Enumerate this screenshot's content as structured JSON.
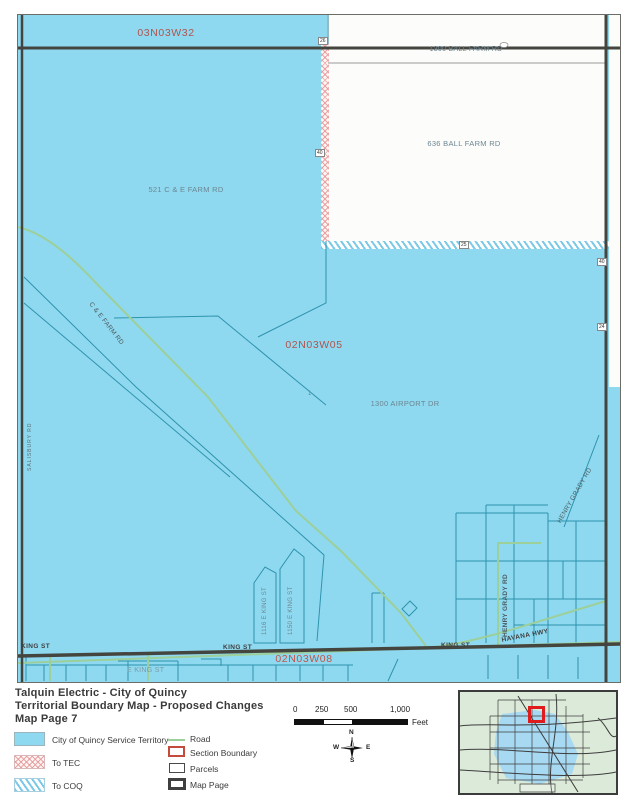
{
  "map": {
    "section_labels": {
      "nw": "03N03W32",
      "center": "02N03W05",
      "south": "02N03W08"
    },
    "parcel_labels": {
      "ball_farm_1300": "1300 BALL FARM RD",
      "ball_farm_636": "636 BALL FARM RD",
      "ce_farm_521": "521 C & E FARM RD",
      "airport_1300": "1300 AIRPORT DR",
      "lot_1": "1",
      "king_1116": "1116 E KING ST",
      "king_1150": "1150 E KING ST"
    },
    "road_labels": {
      "ce_farm": "C & E FARM RD",
      "king_w": "KING ST",
      "king_c": "KING ST",
      "king_e": "KING ST",
      "e_king": "E KING ST",
      "havana": "HAVANA HWY",
      "henry_grady_road": "HENRY GRADY RD",
      "henry_grady_edge": "HENRY GRADY RD",
      "west_edge_road": "SALISBURY RD"
    },
    "edge_markers": {
      "m26": "26",
      "m40a": "40",
      "m25": "25",
      "m40b": "40",
      "m24": "24"
    }
  },
  "legend": {
    "title1": "Talquin Electric - City of Quincy",
    "title2": "Territorial Boundary Map - Proposed Changes",
    "title3": "Map Page 7",
    "items_left": [
      {
        "label": "City of Quincy Service Territory"
      },
      {
        "label": "To TEC"
      },
      {
        "label": "To COQ"
      }
    ],
    "items_right": [
      {
        "label": "Road"
      },
      {
        "label": "Section Boundary"
      },
      {
        "label": "Parcels"
      },
      {
        "label": "Map Page"
      }
    ]
  },
  "scale": {
    "ticks": [
      "0",
      "250",
      "500",
      "1,000"
    ],
    "unit": "Feet"
  },
  "compass": {
    "n": "N",
    "e": "E",
    "s": "S",
    "w": "W"
  },
  "colors": {
    "service_territory_blue": "#8fd9f0",
    "parcel_teal": "#2e93ad",
    "road_green": "#9ccf99",
    "map_page_dark": "#45453f",
    "section_label_red": "#b0544e",
    "section_boundary_red": "#c34a3c",
    "inset_highlight_red": "#e01b1b"
  }
}
